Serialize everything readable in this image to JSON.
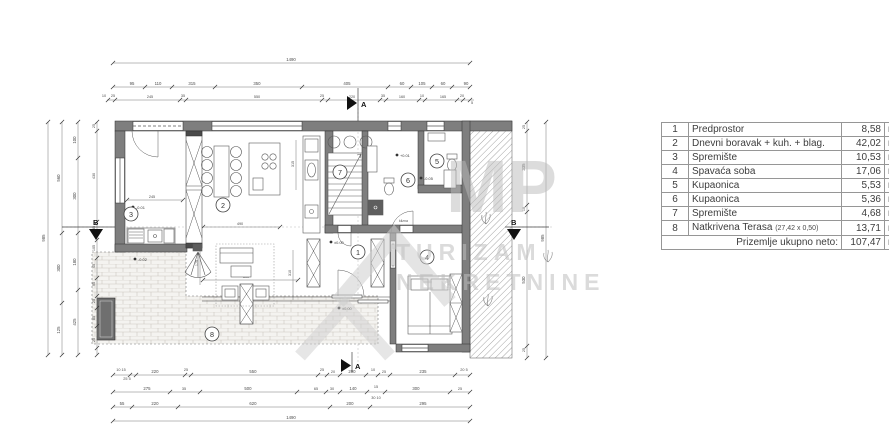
{
  "watermark": {
    "letters": "MP",
    "line1": "TURIZAM",
    "line2": "NEKRETNINE"
  },
  "plan": {
    "rooms": {
      "r1": "1",
      "r2": "2",
      "r3": "3",
      "r4": "4",
      "r5": "5",
      "r6": "6",
      "r7": "7",
      "r8": "8"
    },
    "sections": {
      "a": "A",
      "b": "B"
    },
    "door_label": "klizna",
    "levels": {
      "entry": "±0.00",
      "terrace_door": "±0.00",
      "hall": "+0.01",
      "bath": "-0.05",
      "storage": "-0.01",
      "terrace": "-0.02"
    },
    "dims": {
      "top_total": "1490",
      "top2": [
        "95",
        "110",
        "315",
        "350",
        "405",
        "60",
        "105",
        "60",
        "90"
      ],
      "top3": [
        "10",
        "25",
        "245",
        "35",
        "550",
        "25",
        "220",
        "35",
        "160",
        "10",
        "165",
        "20",
        "5"
      ],
      "bot1": [
        "10 15",
        "25 5",
        "220",
        "25",
        "550",
        "25",
        "20",
        "200",
        "10",
        "25",
        "235",
        "20 5"
      ],
      "bot2": [
        "275",
        "35",
        "500",
        "65",
        "30",
        "140",
        "15",
        "300",
        "25"
      ],
      "bot2_sub": "30  10",
      "bot3": [
        "55",
        "220",
        "620",
        "200",
        "295"
      ],
      "bot_total": "1490",
      "left_total": "985",
      "left2": [
        "560",
        "300",
        "125"
      ],
      "left3": [
        "100",
        "300",
        "180",
        "425"
      ],
      "left4": [
        "25",
        "430",
        "35",
        "105",
        "45",
        "95",
        "25",
        "85",
        "25"
      ],
      "right1": [
        "25",
        "335",
        "10",
        "530",
        "25"
      ],
      "right_total": "985",
      "interior": [
        "245",
        "490",
        "500",
        "310",
        "175",
        "315"
      ]
    }
  },
  "table": {
    "rows": [
      {
        "num": "1",
        "name": "Predprostor",
        "area": "8,58",
        "unit": "m²"
      },
      {
        "num": "2",
        "name": "Dnevni boravak + kuh. + blag.",
        "area": "42,02",
        "unit": "m²"
      },
      {
        "num": "3",
        "name": "Spremište",
        "area": "10,53",
        "unit": "m²"
      },
      {
        "num": "4",
        "name": "Spavaća soba",
        "area": "17,06",
        "unit": "m²"
      },
      {
        "num": "5",
        "name": "Kupaonica",
        "area": "5,53",
        "unit": "m²"
      },
      {
        "num": "6",
        "name": "Kupaonica",
        "area": "5,36",
        "unit": "m²"
      },
      {
        "num": "7",
        "name": "Spremište",
        "area": "4,68",
        "unit": "m²"
      },
      {
        "num": "8",
        "name": "Natkrivena Terasa",
        "note": "(27,42 x 0,50)",
        "area": "13,71",
        "unit": "m²"
      }
    ],
    "total_label": "Prizemlje ukupno neto:",
    "total_area": "107,47",
    "total_unit": "m²"
  }
}
